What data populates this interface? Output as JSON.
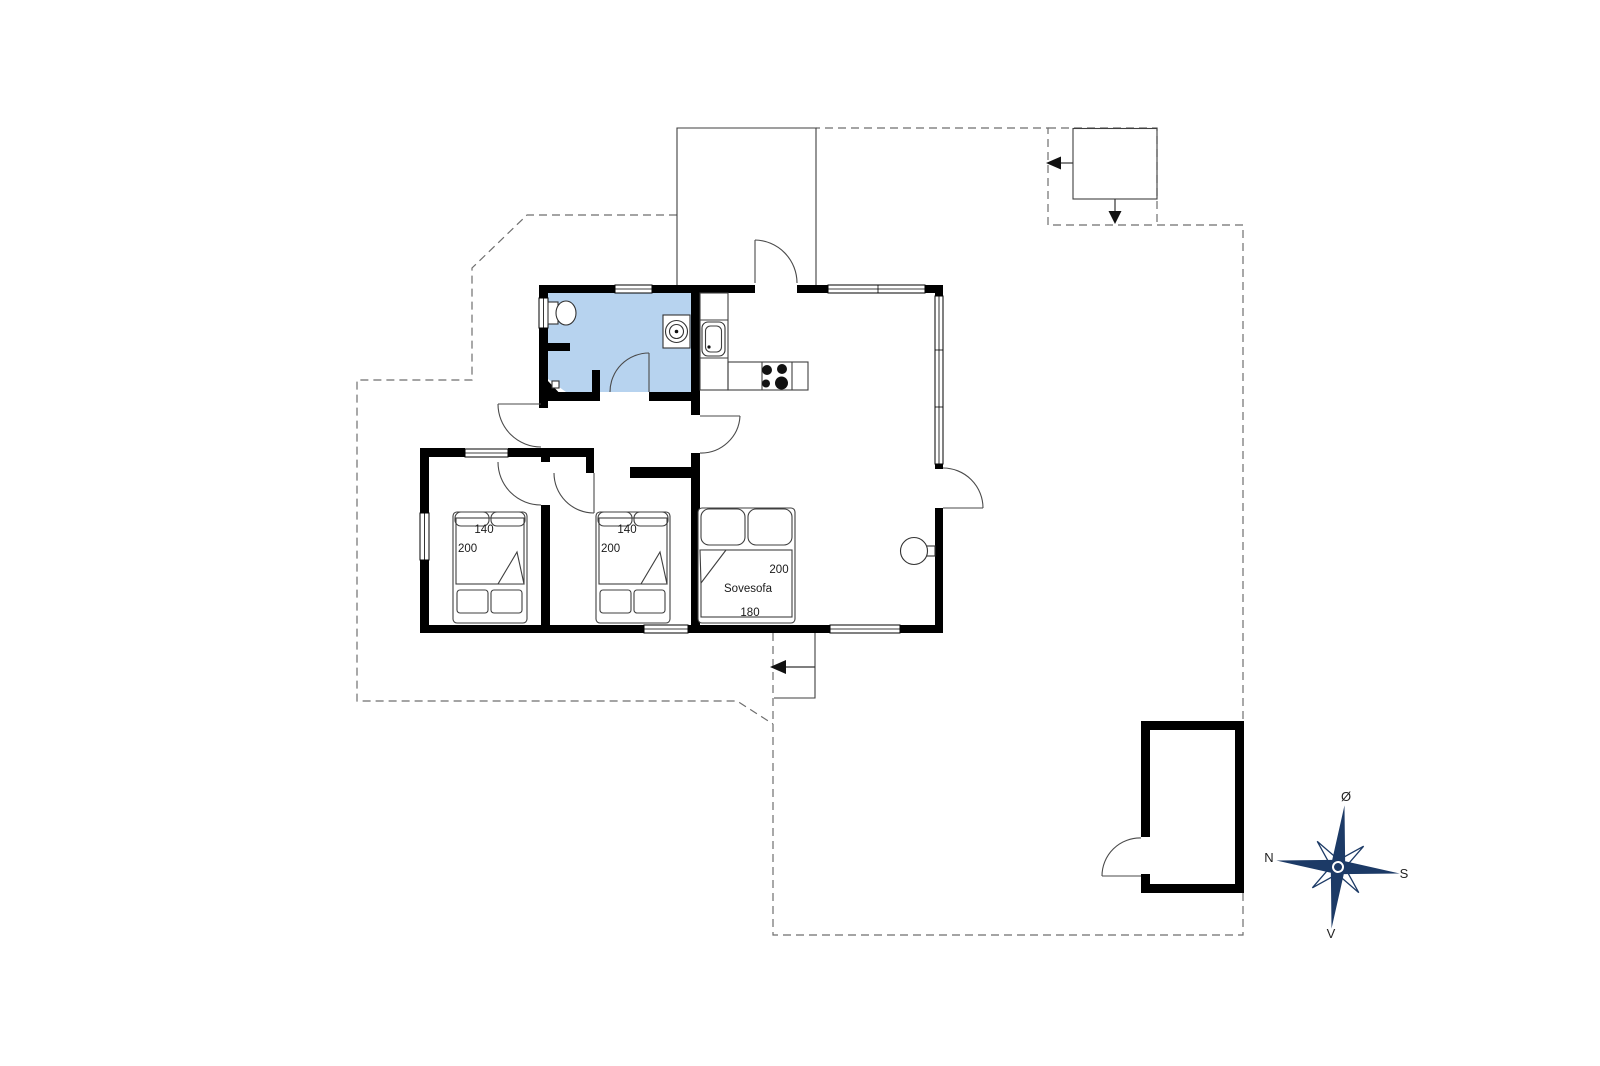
{
  "colors": {
    "bathroom_floor": "#b7d3ef",
    "compass": "#1c3a66",
    "wall": "#000000"
  },
  "rooms": {
    "bedroom1": {
      "bed_width": "140",
      "bed_length": "200"
    },
    "bedroom2": {
      "bed_width": "140",
      "bed_length": "200"
    },
    "alcove": {
      "sofa_label": "Sovesofa",
      "sofa_length": "200",
      "sofa_width": "180"
    }
  },
  "compass": {
    "east": "Ø",
    "south": "S",
    "west": "V",
    "north": "N"
  }
}
